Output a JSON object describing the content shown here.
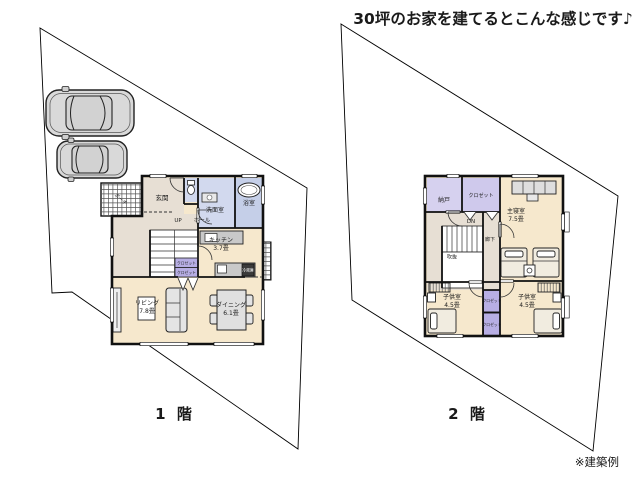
{
  "title": "30坪のお家を建てるとこんな感じです♪",
  "note": "※建築例",
  "floor1": {
    "caption": "1 階",
    "rooms": {
      "porch": "ポーチ",
      "entrance": "玄関",
      "hall": "ホール",
      "stairs_up": "UP",
      "washroom": "洗面室",
      "bath": "浴室",
      "kitchen": "キッチン",
      "kitchen_size": "3.7畳",
      "living": "リビング",
      "living_size": "7.8畳",
      "dining": "ダイニング",
      "dining_size": "6.1畳",
      "closet": "クロゼット",
      "fridge": "冷蔵庫"
    }
  },
  "floor2": {
    "caption": "2 階",
    "rooms": {
      "storage": "納戸",
      "closet": "クロゼット",
      "stairs_down": "DN",
      "void": "吹抜",
      "corridor": "廊下",
      "master_bedroom": "主寝室",
      "master_bedroom_size": "7.5畳",
      "kids_room": "子供室",
      "kids_room_size": "4.5畳"
    }
  },
  "colors": {
    "wall": "#111111",
    "floor_wood": "#f6e8cd",
    "floor_wet": "#d2d9ee",
    "floor_bath": "#c5cfe8",
    "floor_lavender": "#d6d1ef",
    "floor_lavender_light": "#cfc9ec",
    "closet_purple": "#b7aee4",
    "floor_hall": "#e7dfd4",
    "counter_gray": "#c9c9c9",
    "car_gray": "#d9d9d9"
  }
}
